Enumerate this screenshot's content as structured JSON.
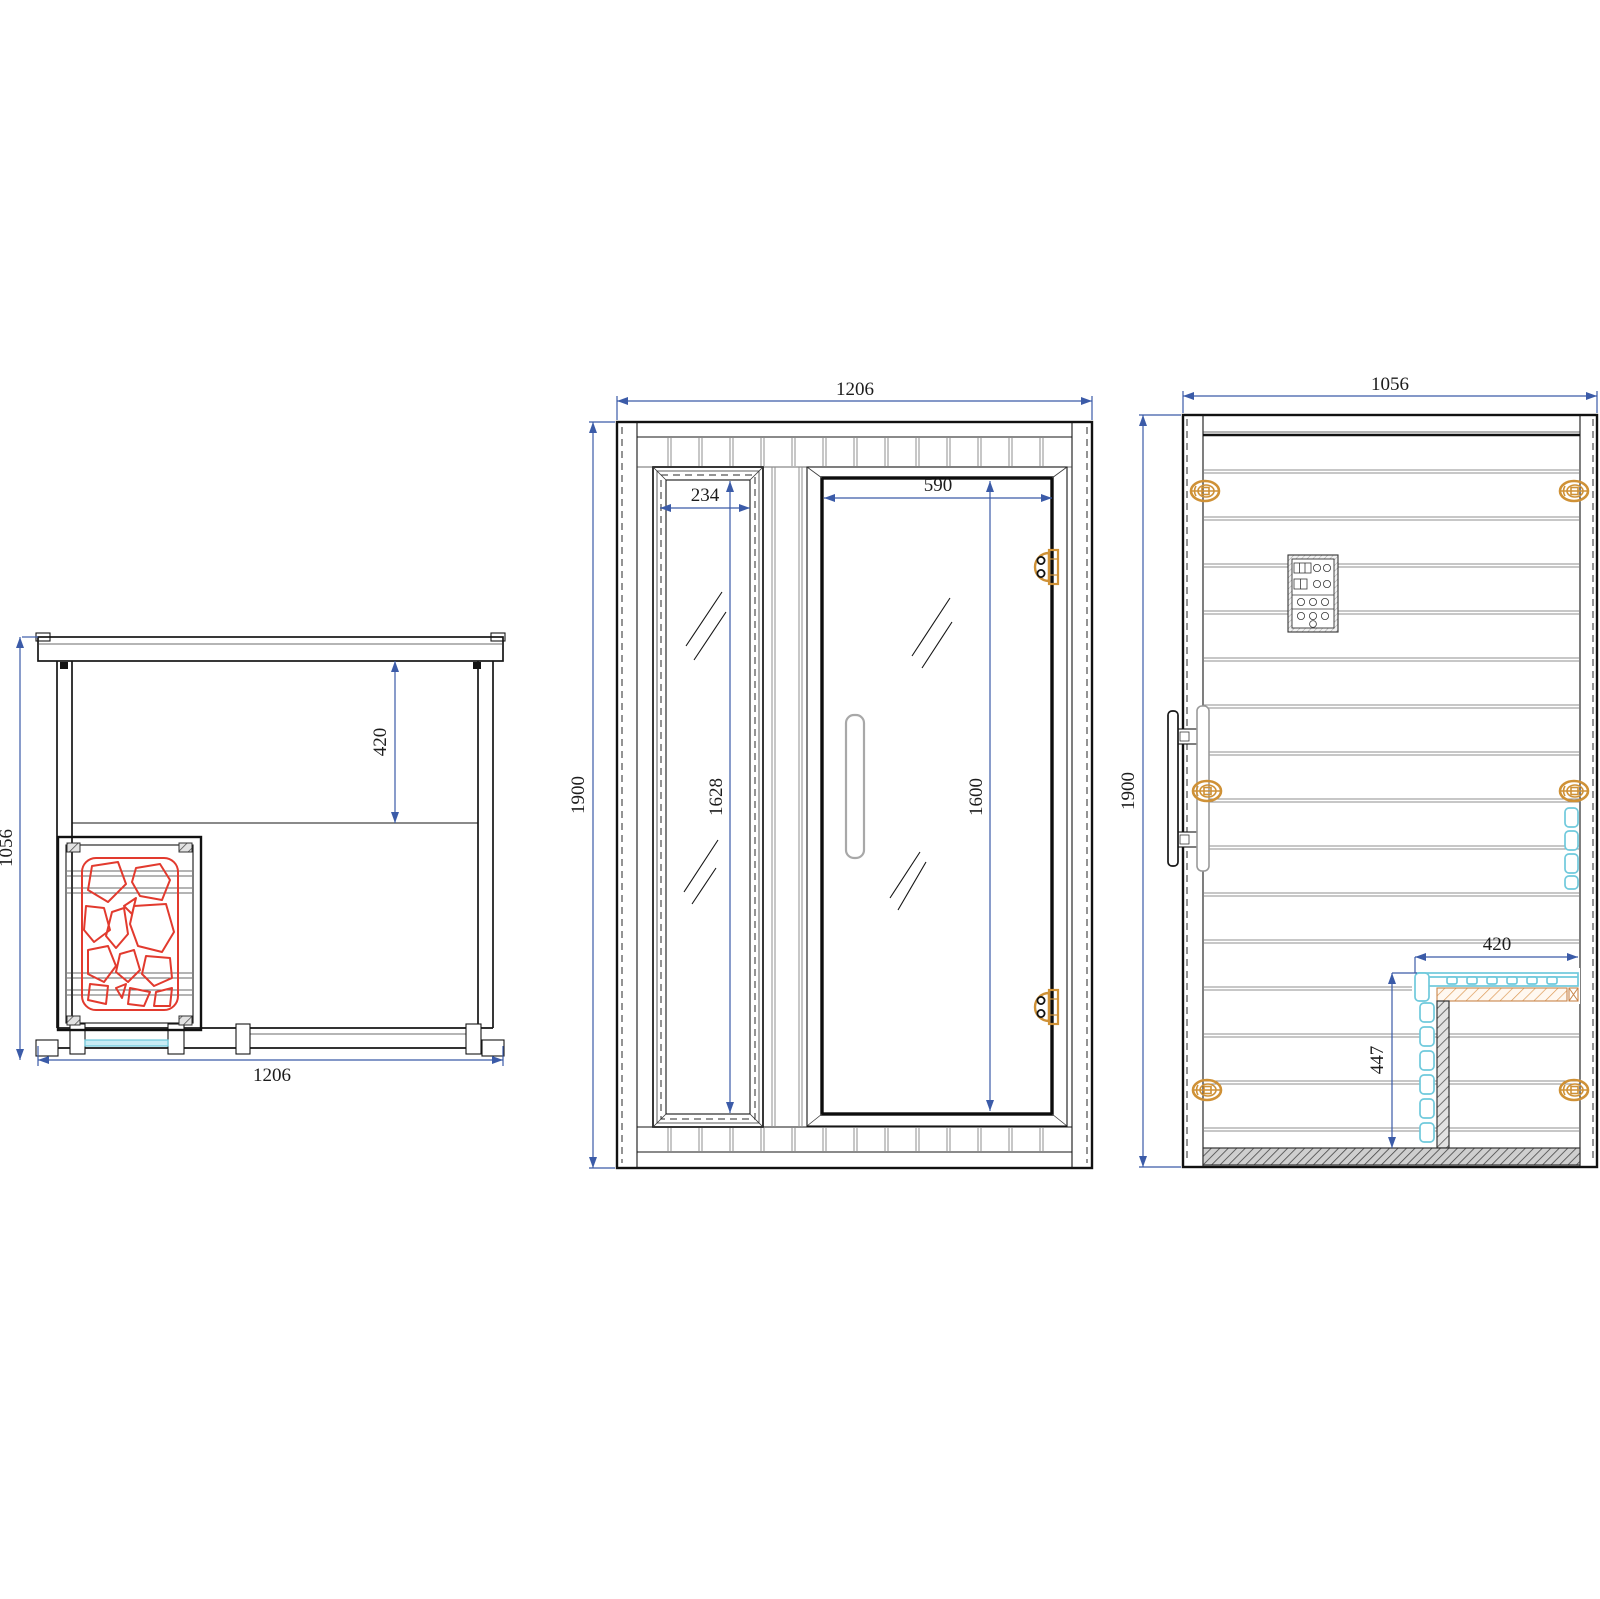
{
  "drawing": {
    "type": "sauna-cabin-three-view-technical-drawing",
    "views": [
      "top-plan-view",
      "front-elevation-view",
      "side-elevation-view"
    ],
    "colors": {
      "dimension_blue": "#3b5ba8",
      "heater_stone_red": "#e23a2e",
      "glass_cyan": "#6fc9dc",
      "hardware_gold": "#cf9136",
      "wood_rail_orange": "#dd9955",
      "hatch_gray": "#555555",
      "outline_black": "#161616"
    }
  },
  "dims": {
    "plan_width": "1206",
    "plan_depth": "1056",
    "plan_bench_depth": "420",
    "front_width": "1206",
    "front_height": "1900",
    "front_window_glass_width": "234",
    "front_window_glass_height": "1628",
    "front_door_glass_width": "590",
    "front_door_glass_height": "1600",
    "side_depth": "1056",
    "side_height": "1900",
    "side_bench_depth": "420",
    "side_bench_height": "447"
  }
}
